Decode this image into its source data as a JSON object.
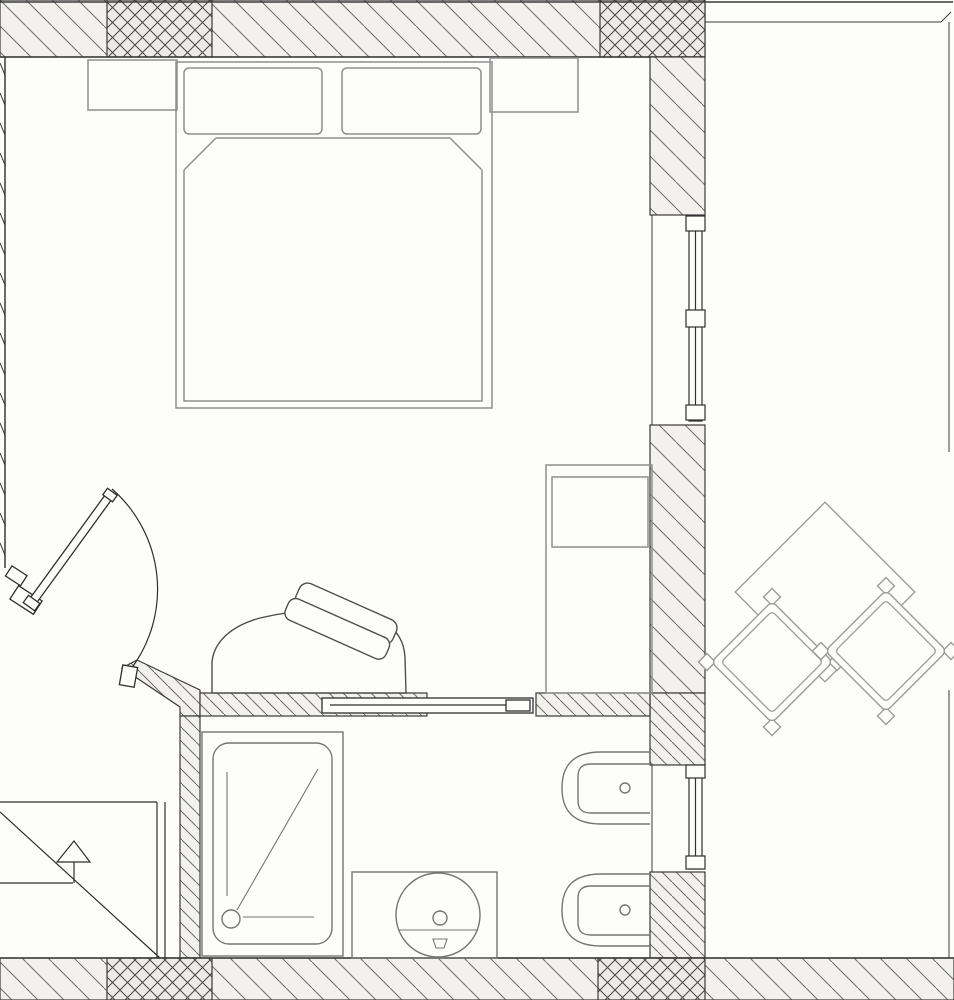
{
  "drawing": {
    "kind": "architectural floor plan",
    "view": "top-down",
    "rooms": [
      "bedroom",
      "bathroom",
      "balcony"
    ]
  },
  "palette": {
    "paper": "#fdfdfc",
    "wall_line": "#3a3a3a",
    "hatch_line": "#6f6f6f",
    "hatch_fill": "#f2f1ee",
    "cross_line": "#474747",
    "cross_fill": "#ecebe7",
    "furniture": "#8f8f8f",
    "fixture": "#757575",
    "outdoor": "#9b9b9b",
    "door": "#2f2f2f",
    "chair": "#4f4f4f"
  },
  "elements": {
    "walls": {
      "label": "hatched masonry walls with cross-hatched column sections"
    },
    "bed": {
      "label": "double bed with two pillows and folded blanket"
    },
    "nightstand_left": {
      "label": "left nightstand"
    },
    "nightstand_right": {
      "label": "right nightstand"
    },
    "wardrobe": {
      "label": "wardrobe cabinet against right wall"
    },
    "armchair": {
      "label": "chair with tilted cushions at bathroom wall"
    },
    "sliding_door": {
      "label": "sliding bathroom door panel"
    },
    "entry_door": {
      "label": "entry door leaf with swing arc"
    },
    "shower": {
      "label": "shower tray with drain and diagonal symbol"
    },
    "vanity": {
      "label": "vanity counter with round washbasin"
    },
    "toilet": {
      "label": "wall-hung toilet"
    },
    "bidet": {
      "label": "wall-hung bidet"
    },
    "window_upper": {
      "label": "full-height window in right wall"
    },
    "window_bathroom": {
      "label": "bathroom window in right wall"
    },
    "stairs": {
      "label": "exterior stair with direction arrow"
    },
    "balcony_table": {
      "label": "square balcony table rotated 45 degrees"
    },
    "balcony_chair_left": {
      "label": "balcony chair rotated 45 degrees"
    },
    "balcony_chair_right": {
      "label": "balcony chair rotated 45 degrees"
    },
    "balcony_rail": {
      "label": "balcony edge line"
    }
  }
}
